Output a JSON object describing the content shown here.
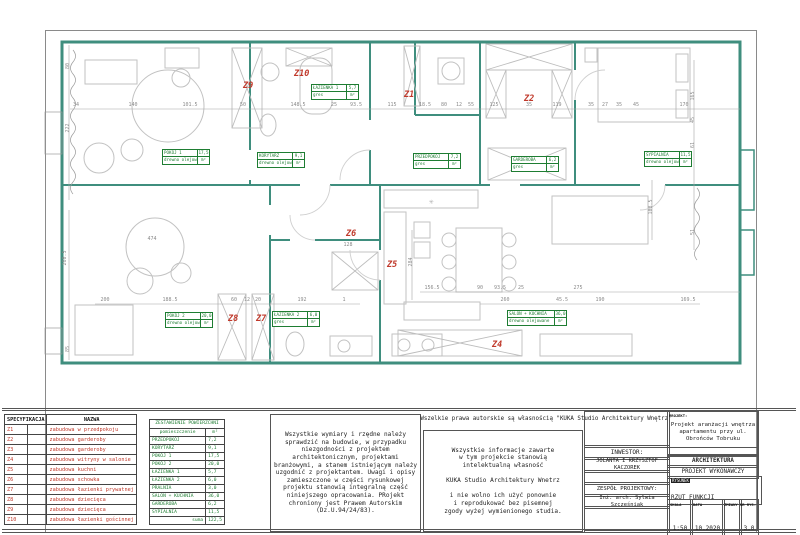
{
  "plan": {
    "z_color": "#c0392b",
    "wall_color": "#3f8e7e",
    "label_color": "#1e7d32",
    "z_labels": [
      {
        "t": "Z9",
        "x": 243,
        "y": 88
      },
      {
        "t": "Z10",
        "x": 294,
        "y": 76
      },
      {
        "t": "Z1",
        "x": 404,
        "y": 97
      },
      {
        "t": "Z2",
        "x": 524,
        "y": 101
      },
      {
        "t": "Z3",
        "x": 522,
        "y": 171
      },
      {
        "t": "Z6",
        "x": 346,
        "y": 236
      },
      {
        "t": "Z5",
        "x": 387,
        "y": 267
      },
      {
        "t": "Z8",
        "x": 228,
        "y": 321
      },
      {
        "t": "Z7",
        "x": 256,
        "y": 321
      },
      {
        "t": "Z4",
        "x": 492,
        "y": 347
      }
    ],
    "room_boxes": [
      {
        "name": "POKÓJ 1",
        "area": "17,5",
        "material": "drewno olejowane",
        "unit": "m²",
        "x": 162,
        "y": 149,
        "w": 46
      },
      {
        "name": "ŁAZIENKA 1",
        "area": "5,7",
        "material": "gres",
        "unit": "m²",
        "x": 311,
        "y": 84,
        "w": 46
      },
      {
        "name": "KORYTARZ",
        "area": "9,1",
        "material": "drewno olejowane",
        "unit": "m²",
        "x": 257,
        "y": 152,
        "w": 46
      },
      {
        "name": "PRZEDPOKÓJ",
        "area": "7,2",
        "material": "gres",
        "unit": "m²",
        "x": 413,
        "y": 153,
        "w": 46
      },
      {
        "name": "GARDEROBA",
        "area": "6,2",
        "material": "gres",
        "unit": "m²",
        "x": 511,
        "y": 156,
        "w": 46
      },
      {
        "name": "SYPIALNIA",
        "area": "11,5",
        "material": "drewno olejowane",
        "unit": "m²",
        "x": 644,
        "y": 151,
        "w": 46
      },
      {
        "name": "POKÓJ 2",
        "area": "20,0",
        "material": "drewno olejowane",
        "unit": "m²",
        "x": 165,
        "y": 312,
        "w": 46
      },
      {
        "name": "ŁAZIENKA 2",
        "area": "6,0",
        "material": "gres",
        "unit": "m²",
        "x": 272,
        "y": 311,
        "w": 46
      },
      {
        "name": "SALON + KUCHNIA",
        "area": "36,0",
        "material": "drewno olejowane",
        "unit": "m²",
        "x": 507,
        "y": 310,
        "w": 58
      }
    ],
    "dimensions": [
      {
        "t": "34",
        "x": 76,
        "y": 106
      },
      {
        "t": "140",
        "x": 133,
        "y": 106
      },
      {
        "t": "101.5",
        "x": 190,
        "y": 106
      },
      {
        "t": "50",
        "x": 243,
        "y": 106
      },
      {
        "t": "148.5",
        "x": 298,
        "y": 106
      },
      {
        "t": "25",
        "x": 334,
        "y": 106
      },
      {
        "t": "93.5",
        "x": 356,
        "y": 106
      },
      {
        "t": "115",
        "x": 392,
        "y": 106
      },
      {
        "t": "18.5",
        "x": 425,
        "y": 106
      },
      {
        "t": "80",
        "x": 444,
        "y": 106
      },
      {
        "t": "12",
        "x": 459,
        "y": 106
      },
      {
        "t": "55",
        "x": 471,
        "y": 106
      },
      {
        "t": "125",
        "x": 494,
        "y": 106
      },
      {
        "t": "35",
        "x": 529,
        "y": 106
      },
      {
        "t": "119",
        "x": 557,
        "y": 106
      },
      {
        "t": "35",
        "x": 591,
        "y": 106
      },
      {
        "t": "27",
        "x": 605,
        "y": 106
      },
      {
        "t": "35",
        "x": 619,
        "y": 106
      },
      {
        "t": "45",
        "x": 636,
        "y": 106
      },
      {
        "t": "170",
        "x": 684,
        "y": 106
      },
      {
        "t": "156.5",
        "x": 432,
        "y": 289
      },
      {
        "t": "90",
        "x": 480,
        "y": 289
      },
      {
        "t": "93.5",
        "x": 500,
        "y": 289
      },
      {
        "t": "25",
        "x": 521,
        "y": 289
      },
      {
        "t": "275",
        "x": 578,
        "y": 289
      },
      {
        "t": "200",
        "x": 105,
        "y": 301
      },
      {
        "t": "188.5",
        "x": 170,
        "y": 301
      },
      {
        "t": "60",
        "x": 234,
        "y": 301
      },
      {
        "t": "12",
        "x": 247,
        "y": 301
      },
      {
        "t": "20",
        "x": 258,
        "y": 301
      },
      {
        "t": "192",
        "x": 302,
        "y": 301
      },
      {
        "t": "1",
        "x": 344,
        "y": 301
      },
      {
        "t": "260",
        "x": 505,
        "y": 301
      },
      {
        "t": "45.5",
        "x": 562,
        "y": 301
      },
      {
        "t": "190",
        "x": 600,
        "y": 301
      },
      {
        "t": "169.5",
        "x": 688,
        "y": 301
      },
      {
        "t": "128",
        "x": 348,
        "y": 246
      },
      {
        "t": "474",
        "x": 152,
        "y": 240
      },
      {
        "t": "80",
        "x": 69,
        "y": 66,
        "r": 1
      },
      {
        "t": "222",
        "x": 69,
        "y": 128,
        "r": 1
      },
      {
        "t": "260.5",
        "x": 66,
        "y": 258,
        "r": 1
      },
      {
        "t": "85",
        "x": 69,
        "y": 349,
        "r": 1
      },
      {
        "t": "165",
        "x": 694,
        "y": 96,
        "r": 1
      },
      {
        "t": "45",
        "x": 694,
        "y": 120,
        "r": 1
      },
      {
        "t": "61",
        "x": 694,
        "y": 145,
        "r": 1
      },
      {
        "t": "51",
        "x": 694,
        "y": 232,
        "r": 1
      },
      {
        "t": "284",
        "x": 412,
        "y": 262,
        "r": 1
      },
      {
        "t": "108.5",
        "x": 652,
        "y": 207,
        "r": 1
      }
    ],
    "symbols": [
      {
        "t": "✳",
        "x": 429,
        "y": 204
      }
    ]
  },
  "spec_table": {
    "header_col1": "SPECYFIKACJA",
    "header_col2": "NAZWA",
    "rows": [
      [
        "Z1",
        "zabudowa w przedpokoju"
      ],
      [
        "Z2",
        "zabudowa garderoby"
      ],
      [
        "Z3",
        "zabudowa garderoby"
      ],
      [
        "Z4",
        "zabudowa witryny w salonie"
      ],
      [
        "Z5",
        "zabudowa kuchni"
      ],
      [
        "Z6",
        "zabudowa schowka"
      ],
      [
        "Z7",
        "zabudowa łazienki prywatnej"
      ],
      [
        "Z8",
        "zabudowa dziecięca"
      ],
      [
        "Z9",
        "zabudowa dziecięca"
      ],
      [
        "Z10",
        "zabudowa łazienki gościnnej"
      ]
    ]
  },
  "area_table": {
    "title": "ZESTAWIENIE POWIERZCHNI",
    "col1": "pomieszczenie",
    "col2": "m²",
    "rows": [
      [
        "PRZEDPOKÓJ",
        "7,2"
      ],
      [
        "KORYTARZ",
        "9,1"
      ],
      [
        "POKÓJ 1",
        "17,5"
      ],
      [
        "POKÓJ 2",
        "20,0"
      ],
      [
        "ŁAZIENKA 1",
        "5,7"
      ],
      [
        "ŁAZIENKA 2",
        "6,0"
      ],
      [
        "PRALNIA",
        "3,0"
      ],
      [
        "SALON + KUCHNIA",
        "36,0"
      ],
      [
        "GARDEROBA",
        "6,2"
      ],
      [
        "SYPIALNIA",
        "11,5"
      ]
    ],
    "sum_label": "suma",
    "sum_value": "122,5"
  },
  "notes": {
    "note1": "Wszystkie wymiary i rzędne należy sprawdzić na budowie, w przypadku niezgodności z projektem architektonicznym, projektami branżowymi, a stanem istniejącym należy uzgodnić z projektantem. Uwagi i opisy zamieszczone w części rysunkowej projektu stanowią integralną część niniejszego opracowania. PRojekt chroniony jest Prawem Autorskim (Dz.U.94/24/83).",
    "copyright": "Wszelkie prawa autorskie są własnością \"KUKA Studio Architektury Wnętrz\"",
    "note2_lines": [
      "Wszystkie informacje zawarte",
      "w tym projekcie stanowią",
      "intelektualną własność",
      "",
      "KUKA Studio Architektury Wnetrz",
      "",
      "i nie wolno ich użyć ponownie",
      "i reprodukować bez pisemnej",
      "zgody wyżej wymienionego studia."
    ]
  },
  "title_block": {
    "projekt_label": "PROJEKT:",
    "projekt": "Projekt aranżacji wnętrza apartamentu przy ul. Obrońców Tobruku",
    "inwestor_label": "INWESTOR:",
    "inwestor": "JOLANTA I KRZYSZTOF KACZOREK",
    "branza": "ARCHITEKTURA",
    "faza": "PROJEKT WYKONAWCZY",
    "zespol_label": "ZESPÓŁ PROJEKTOWY:",
    "zespol": "Inż. arch. Sylwia Szczęśniak",
    "rysunek_label": "RYSUNEK",
    "rysunek": "RZUT FUNKCJI",
    "skala_label": "SKALA",
    "skala": "1:50",
    "data_label": "DATA",
    "data": "10.2020",
    "zmiany_label": "ZMIANY",
    "zmiany": "",
    "nr_label": "NR RYS.",
    "nr": "3.0"
  }
}
